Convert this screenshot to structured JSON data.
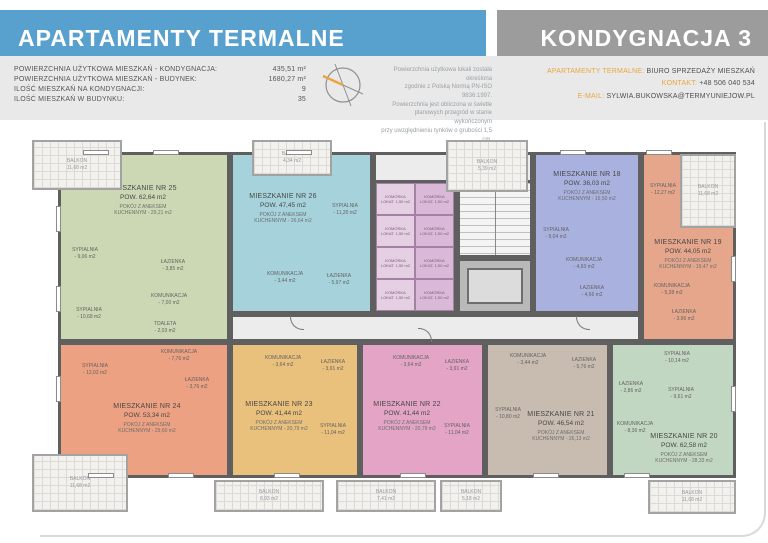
{
  "header": {
    "title": "APARTAMENTY TERMALNE",
    "floor_label": "KONDYGNACJA 3",
    "stats": [
      {
        "label": "POWIERZCHNIA UŻYTKOWA MIESZKAŃ - KONDYGNACJA:",
        "value": "435,51 m²"
      },
      {
        "label": "POWIERZCHNIA UŻYTKOWA MIESZKAŃ - BUDYNEK:",
        "value": "1680,27 m²"
      },
      {
        "label": "ILOŚĆ MIESZKAŃ NA KONDYGNACJI:",
        "value": "9"
      },
      {
        "label": "ILOŚĆ MIESZKAŃ W BUDYNKU:",
        "value": "35"
      }
    ],
    "note_lines": [
      "Powierzchnia użytkowa lokali została określona",
      "zgodnie z Polską Normą PN-ISO 9836:1997.",
      "Powierzchnia jest obliczona w świetle",
      "planowych przegród w stanie wykończonym",
      "przy uwzględnieniu tynków o grubości 1,5 cm."
    ],
    "contact": [
      {
        "label": "APARTAMENTY TERMALNE:",
        "value": "BIURO SPRZEDAŻY MIESZKAŃ"
      },
      {
        "label": "KONTAKT:",
        "value": "+48 506 040 534"
      },
      {
        "label": "E-MAIL:",
        "value": "SYLWIA.BUKOWSKA@TERMYUNIEJOW.PL"
      }
    ],
    "compass_icon": "compass-rose-icon"
  },
  "colors": {
    "band_blue": "#58a1ce",
    "band_gray": "#9c9c9c",
    "accent_orange": "#eba53f",
    "strip_gray": "#e9e9e9",
    "wall_gray": "#5f5f5f",
    "corridor_gray": "#ececec"
  },
  "plan": {
    "balcony_label": "BALKON",
    "storage_cell": {
      "label": "KOMÓRKA",
      "area": "LOKAT. 1,50 m2"
    },
    "balconies": [
      "11,68 m2",
      "4,34 m2",
      "5,39 m2",
      "11,68 m2",
      "11,68 m2",
      "8,93 m2",
      "7,41 m2",
      "5,18 m2",
      "11,68 m2"
    ],
    "apartments": [
      {
        "number": "25",
        "name": "MIESZKANIE NR 25",
        "area": "POW. 62,64 m2",
        "kitchen1": "POKÓJ Z ANEKSEM",
        "kitchen2": "KUCHENNYM - 29,21 m2",
        "color": "#ccd8b4",
        "rooms": [
          {
            "label": "SYPIALNIA",
            "area": "- 9,06 m2"
          },
          {
            "label": "ŁAZIENKA",
            "area": "- 3,85 m2"
          },
          {
            "label": "KOMUNIKACJA",
            "area": "- 7,00 m2"
          },
          {
            "label": "SYPIALNIA",
            "area": "- 10,68 m2"
          },
          {
            "label": "TOALETA",
            "area": "- 2,03 m2"
          }
        ]
      },
      {
        "number": "26",
        "name": "MIESZKANIE NR 26",
        "area": "POW. 47,45 m2",
        "kitchen1": "POKÓJ Z ANEKSEM",
        "kitchen2": "KUCHENNYM - 26,64 m2",
        "color": "#a6d2dc",
        "rooms": [
          {
            "label": "SYPIALNIA",
            "area": "- 11,20 m2"
          },
          {
            "label": "KOMUNIKACJA",
            "area": "- 3,44 m2"
          },
          {
            "label": "ŁAZIENKA",
            "area": "- 5,97 m2"
          }
        ]
      },
      {
        "number": "18",
        "name": "MIESZKANIE NR 18",
        "area": "POW. 36,03 m2",
        "kitchen1": "POKÓJ Z ANEKSEM",
        "kitchen2": "KUCHENNYM - 16,50 m2",
        "color": "#a9b2de",
        "rooms": [
          {
            "label": "SYPIALNIA",
            "area": "- 9,04 m2"
          },
          {
            "label": "KOMUNIKACJA",
            "area": "- 4,93 m2"
          },
          {
            "label": "ŁAZIENKA",
            "area": "- 4,66 m2"
          }
        ]
      },
      {
        "number": "19",
        "name": "MIESZKANIE NR 19",
        "area": "POW. 44,05 m2",
        "kitchen1": "POKÓJ Z ANEKSEM",
        "kitchen2": "KUCHENNYM - 19,47 m2",
        "color": "#e5a68c",
        "rooms": [
          {
            "label": "SYPIALNIA",
            "area": "- 12,27 m2"
          },
          {
            "label": "KOMUNIKACJA",
            "area": "- 5,38 m2"
          },
          {
            "label": "ŁAZIENKA",
            "area": "- 3,96 m2"
          }
        ]
      },
      {
        "number": "24",
        "name": "MIESZKANIE NR 24",
        "area": "POW. 53,34 m2",
        "kitchen1": "POKÓJ Z ANEKSEM",
        "kitchen2": "KUCHENNYM - 29,60 m2",
        "color": "#eca182",
        "rooms": [
          {
            "label": "KOMUNIKACJA",
            "area": "- 7,76 m2"
          },
          {
            "label": "SYPIALNIA",
            "area": "- 12,02 m2"
          },
          {
            "label": "ŁAZIENKA",
            "area": "- 3,76 m2"
          }
        ]
      },
      {
        "number": "23",
        "name": "MIESZKANIE NR 23",
        "area": "POW. 41,44 m2",
        "kitchen1": "POKÓJ Z ANEKSEM",
        "kitchen2": "KUCHENNYM - 20,79 m2",
        "color": "#e9c07c",
        "rooms": [
          {
            "label": "KOMUNIKACJA",
            "area": "- 3,64 m2"
          },
          {
            "label": "ŁAZIENKA",
            "area": "- 3,91 m2"
          },
          {
            "label": "SYPIALNIA",
            "area": "- 11,04 m2"
          }
        ]
      },
      {
        "number": "22",
        "name": "MIESZKANIE NR 22",
        "area": "POW. 41,44 m2",
        "kitchen1": "POKÓJ Z ANEKSEM",
        "kitchen2": "KUCHENNYM - 20,79 m2",
        "color": "#e3a4c6",
        "rooms": [
          {
            "label": "KOMUNIKACJA",
            "area": "- 3,64 m2"
          },
          {
            "label": "ŁAZIENKA",
            "area": "- 3,91 m2"
          },
          {
            "label": "SYPIALNIA",
            "area": "- 11,04 m2"
          }
        ]
      },
      {
        "number": "21",
        "name": "MIESZKANIE NR 21",
        "area": "POW. 46,54 m2",
        "kitchen1": "POKÓJ Z ANEKSEM",
        "kitchen2": "KUCHENNYM - 26,13 m2",
        "color": "#c8bcb0",
        "rooms": [
          {
            "label": "KOMUNIKACJA",
            "area": "- 3,44 m2"
          },
          {
            "label": "ŁAZIENKA",
            "area": "- 5,76 m2"
          },
          {
            "label": "SYPIALNIA",
            "area": "- 10,80 m2"
          }
        ]
      },
      {
        "number": "20",
        "name": "MIESZKANIE NR 20",
        "area": "POW. 62,58 m2",
        "kitchen1": "POKÓJ Z ANEKSEM",
        "kitchen2": "KUCHENNYM - 28,33 m2",
        "color": "#c2d7c1",
        "rooms": [
          {
            "label": "SYPIALNIA",
            "area": "- 10,14 m2"
          },
          {
            "label": "SYPIALNIA",
            "area": "- 9,61 m2"
          },
          {
            "label": "ŁAZIENKA",
            "area": "- 2,86 m2"
          },
          {
            "label": "KOMUNIKACJA",
            "area": "- 8,36 m2"
          }
        ]
      }
    ]
  }
}
